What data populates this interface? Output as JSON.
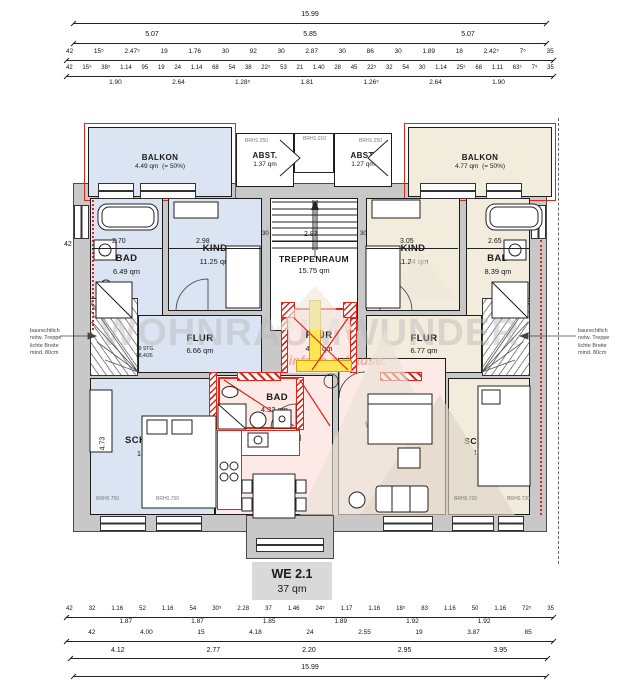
{
  "unit": {
    "name": "WE 2.1",
    "area": "37 qm"
  },
  "watermark": {
    "brand": "WOHNRAUMWUNDER",
    "tagline": "Einfach zuhause."
  },
  "rooms": {
    "balkon_l": {
      "label": "BALKON",
      "area": "4.49 qm",
      "note": "(= 50%)"
    },
    "balkon_r": {
      "label": "BALKON",
      "area": "4.77 qm",
      "note": "(= 50%)"
    },
    "abst_l": {
      "label": "ABST.",
      "area": "1.37 qm"
    },
    "abst_r": {
      "label": "ABST.",
      "area": "1.27 qm"
    },
    "treppenraum": {
      "label": "TREPPENRAUM",
      "area": "15.75 qm"
    },
    "bad_l": {
      "label": "BAD",
      "area": "6.49 qm"
    },
    "kind_l": {
      "label": "KIND",
      "area": "11.25 qm"
    },
    "flur_l": {
      "label": "FLUR",
      "area": "6.66 qm"
    },
    "schlafen_l": {
      "label": "SCHLAFEN",
      "area": "18.85 qm"
    },
    "kind_r": {
      "label": "KIND",
      "area": "11.24 qm"
    },
    "bad_r": {
      "label": "BAD",
      "area": "8.39 qm"
    },
    "flur_r": {
      "label": "FLUR",
      "area": "6.77 qm"
    },
    "schlafen_r": {
      "label": "SCHLAFEN",
      "area": "18.39 qm"
    },
    "flur_m": {
      "label": "FLUR",
      "area": "4.47 qm"
    },
    "bad_m": {
      "label": "BAD",
      "area": "4.32 qm"
    },
    "ko_essen": {
      "label": "KO./ESSEN",
      "area": "15.87 qm"
    },
    "wo_schl": {
      "label": "WO./SCHL.",
      "area": "12.06 qm"
    }
  },
  "notes": {
    "treppe_lines": [
      "baurechtlich",
      "notw. Treppe",
      "lichte Breite",
      "mind. 80cm"
    ],
    "stair_spec": [
      "19 STG.",
      "18,4/26"
    ]
  },
  "brh": {
    "top_l": "BRH1.250",
    "top_m": "BRH1.010",
    "top_r": "BRH1.250",
    "bl1": "BRH0.750",
    "bl2": "BRH0.750",
    "br1": "BRH0.720",
    "br2": "BRH0.720"
  },
  "interior_dims": {
    "left_wall": "42",
    "bad_l": "2.70",
    "kind_l": "2.98",
    "stair_30l": "30",
    "stair": "2.87",
    "stair_30r": "30",
    "kind_r": "3.05",
    "bad_r": "2.65",
    "schlafen_v": "4.73"
  },
  "dims_top": {
    "total": [
      "15.99"
    ],
    "thirds": [
      "5.07",
      "5.85",
      "5.07"
    ],
    "row3": [
      "42",
      "15⁵",
      "2.47⁵",
      "19",
      "1.76",
      "30",
      "92",
      "30",
      "2.87",
      "30",
      "86",
      "30",
      "1.89",
      "18",
      "2.42⁵",
      "7⁵",
      "35"
    ],
    "row4": [
      "42",
      "15⁵",
      "38⁵",
      "1.14",
      "95",
      "19",
      "24",
      "1.14",
      "68",
      "54",
      "38",
      "22⁵",
      "53",
      "21",
      "1.40",
      "28",
      "45",
      "22⁵",
      "32",
      "54",
      "30",
      "1.14",
      "25⁵",
      "68",
      "1.11",
      "63⁵",
      "7⁵",
      "35"
    ],
    "row5": [
      "1.90",
      "2.64",
      "1.28⁵",
      "1.81",
      "1.26⁵",
      "2.64",
      "1.90"
    ]
  },
  "dims_bottom": {
    "row1": [
      "42",
      "32",
      "1.16",
      "52",
      "1.16",
      "54",
      "30⁵",
      "2.28",
      "37",
      "1.46",
      "24⁵",
      "1.17",
      "1.16",
      "18⁵",
      "83",
      "1.16",
      "50",
      "1.16",
      "72⁵",
      "35"
    ],
    "row1b": [
      "1.87",
      "1.87",
      "1.85",
      "1.89",
      "1.92",
      "1.92"
    ],
    "row2": [
      "42",
      "4.00",
      "15",
      "4.18",
      "24",
      "2.55",
      "19",
      "3.87",
      "85"
    ],
    "row3": [
      "4.12",
      "2.77",
      "2.20",
      "2.95",
      "3.95"
    ],
    "total": [
      "15.99"
    ]
  },
  "colors": {
    "new_red": "#e0251b",
    "highlight_yellow": "#ffe554",
    "unit_left_blue": "#dbe4f2",
    "unit_right_beige": "#f2ecdc",
    "unit_we21_pink": "#fde9e6",
    "wall_gray": "#c8c8c8"
  }
}
